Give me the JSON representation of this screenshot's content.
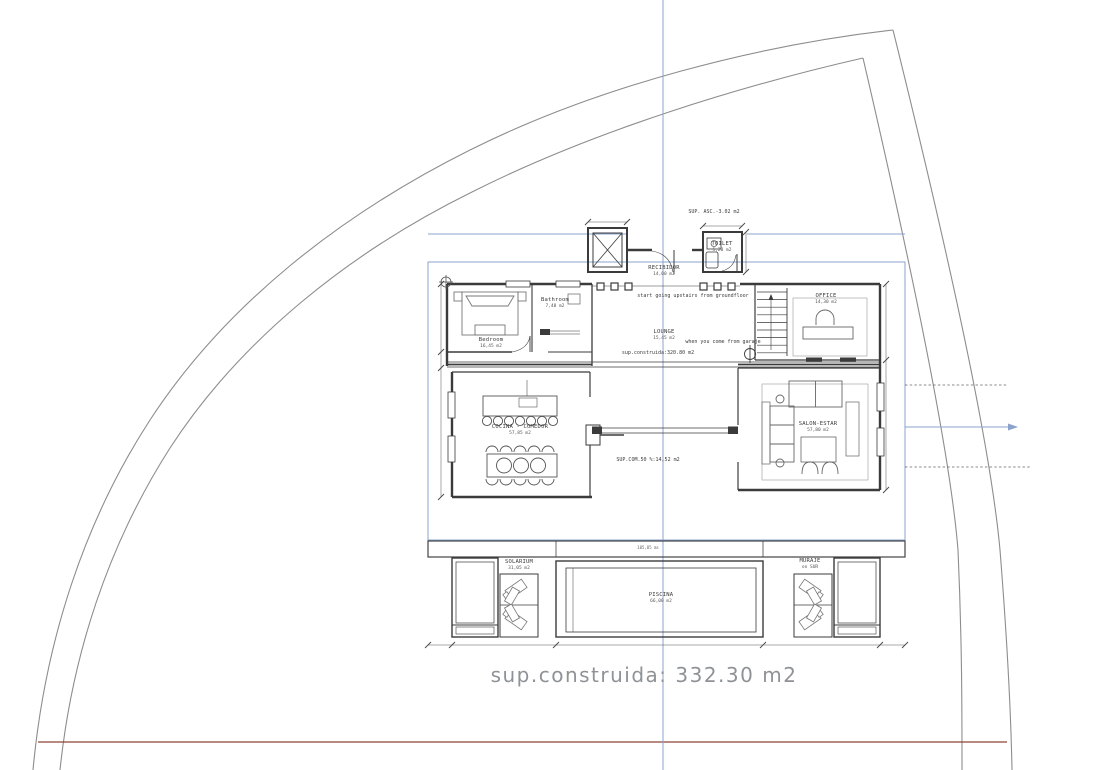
{
  "colors": {
    "reference_blue": "#8ba3cc",
    "wall_dark": "#3b3b3b",
    "boundary_gray": "#8d8d8d",
    "site_red_line": "#8f4438",
    "footer_text_gray": "#8f9296"
  },
  "annotations": {
    "sup_asc": "SUP. ASC.-3.02 m2",
    "stairs_note": "start going upstairs from groundfloor",
    "construida_note": "sup.construida:320.80 m2",
    "garaje_note": "when you come from garaje",
    "sup_com_note": "SUP.COM.50 %:14,52 m2",
    "terrace_dim": "105,85 ms",
    "footer": "sup.construida: 332.30  m2"
  },
  "rooms": {
    "toilet": {
      "name": "TOILET",
      "area": "5,20 m2"
    },
    "recibidor": {
      "name": "RECIBIDOR",
      "area": "14,00 m2"
    },
    "bedroom": {
      "name": "Bedroom",
      "area": "16,45 m2"
    },
    "bathroom": {
      "name": "Bathroom",
      "area": "7,48 m2"
    },
    "lounge": {
      "name": "LOUNGE",
      "area": "15,45 m2"
    },
    "office": {
      "name": "OFFICE",
      "area": "14,30 m2"
    },
    "cocina": {
      "name": "COCINA - COMEDOR",
      "area": "57,85 m2"
    },
    "salon": {
      "name": "SALON-ESTAR",
      "area": "57,80 m2"
    },
    "solarium": {
      "name": "SOLARIUM",
      "area": "31,05 m2"
    },
    "piscina": {
      "name": "PISCINA",
      "area": "66,00 m2"
    },
    "muraje": {
      "name": "MURAJE",
      "area": "on SUR"
    }
  }
}
